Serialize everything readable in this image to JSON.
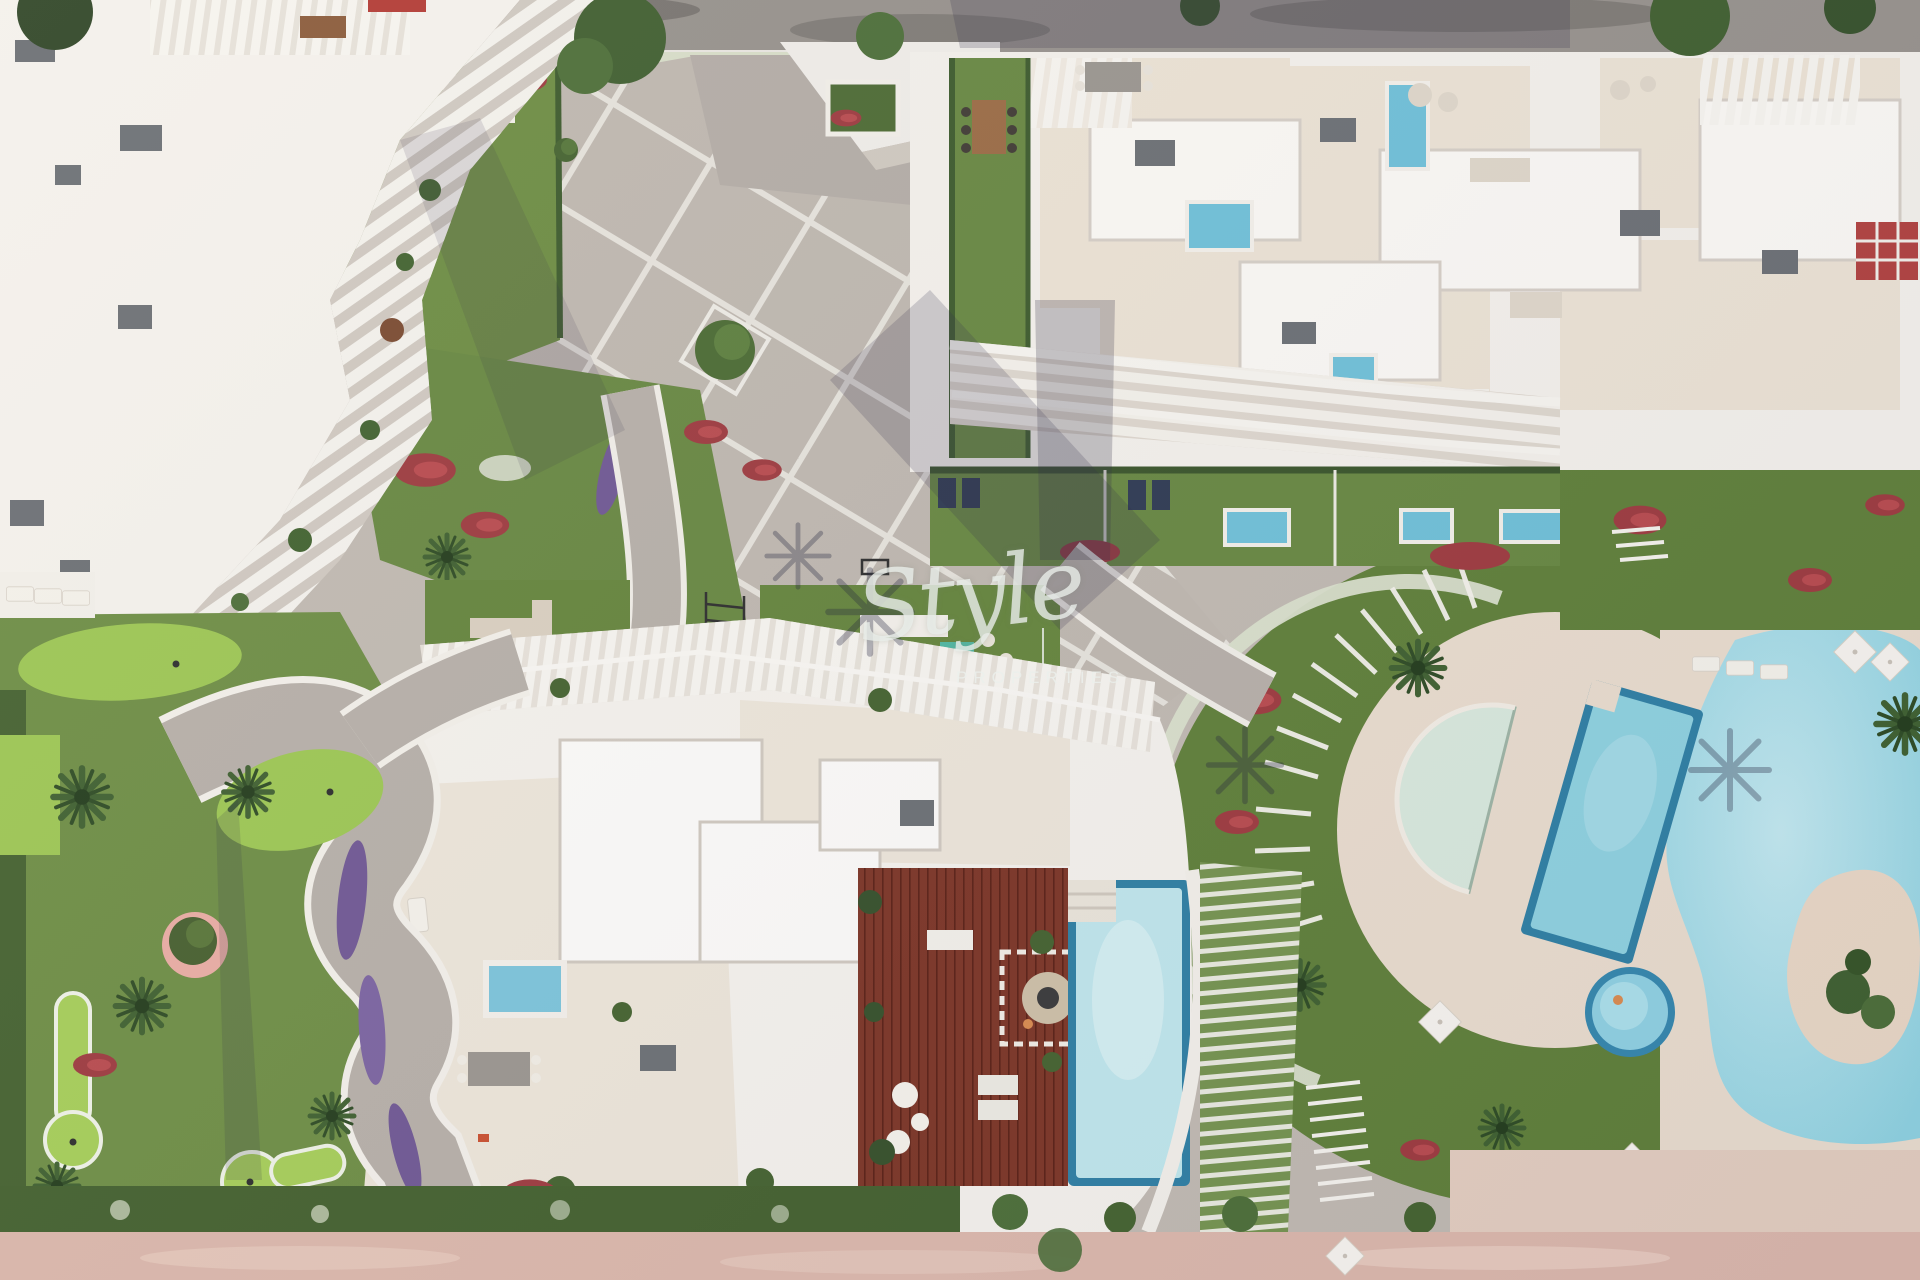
{
  "image": {
    "kind": "aerial-3d-architectural-render",
    "subject": "Top-down view of a modern white residential complex with curved louvered buildings, rooftop terraces and plunge pools, central paved plaza, gardens with palms and red and purple flowers, mini-golf greens, a circular pool deck with semicircular pool, tilted lap pool, free-form lagoon pool with sand island, wooden roof deck with large rooftop pool, and a pink promenade along the bottom"
  },
  "watermark": {
    "brand_script": "Style",
    "brand_caption": "PROPERTIES",
    "separator_bar": "|"
  },
  "palette": {
    "paving_base": "#c0b9b1",
    "plaza_grid_line": "#ece9e3",
    "road_asphalt": "#96918c",
    "building_white": "#f4f1ec",
    "terrace_beige": "#ebe3d5",
    "lawn_green": "#6a8a42",
    "lawn_dark": "#52702f",
    "golf_bright_green": "#a5cd58",
    "hedge_dark": "#3c5a2c",
    "hedge_white_flower": "#d9dfcb",
    "flower_red": "#9d3a3f",
    "flower_purple": "#6f5793",
    "pool_blue": "#6fc0d8",
    "pool_pale": "#bfe6ec",
    "pool_semicircle_pale_green": "#d8e8dc",
    "lagoon_aqua": "#a9dde8",
    "wood_deck_brown": "#7c3526",
    "sand_beige": "#e6d2c2",
    "promenade_pink": "#dbb7ab",
    "shadow_indigo": "#2e2a45"
  }
}
